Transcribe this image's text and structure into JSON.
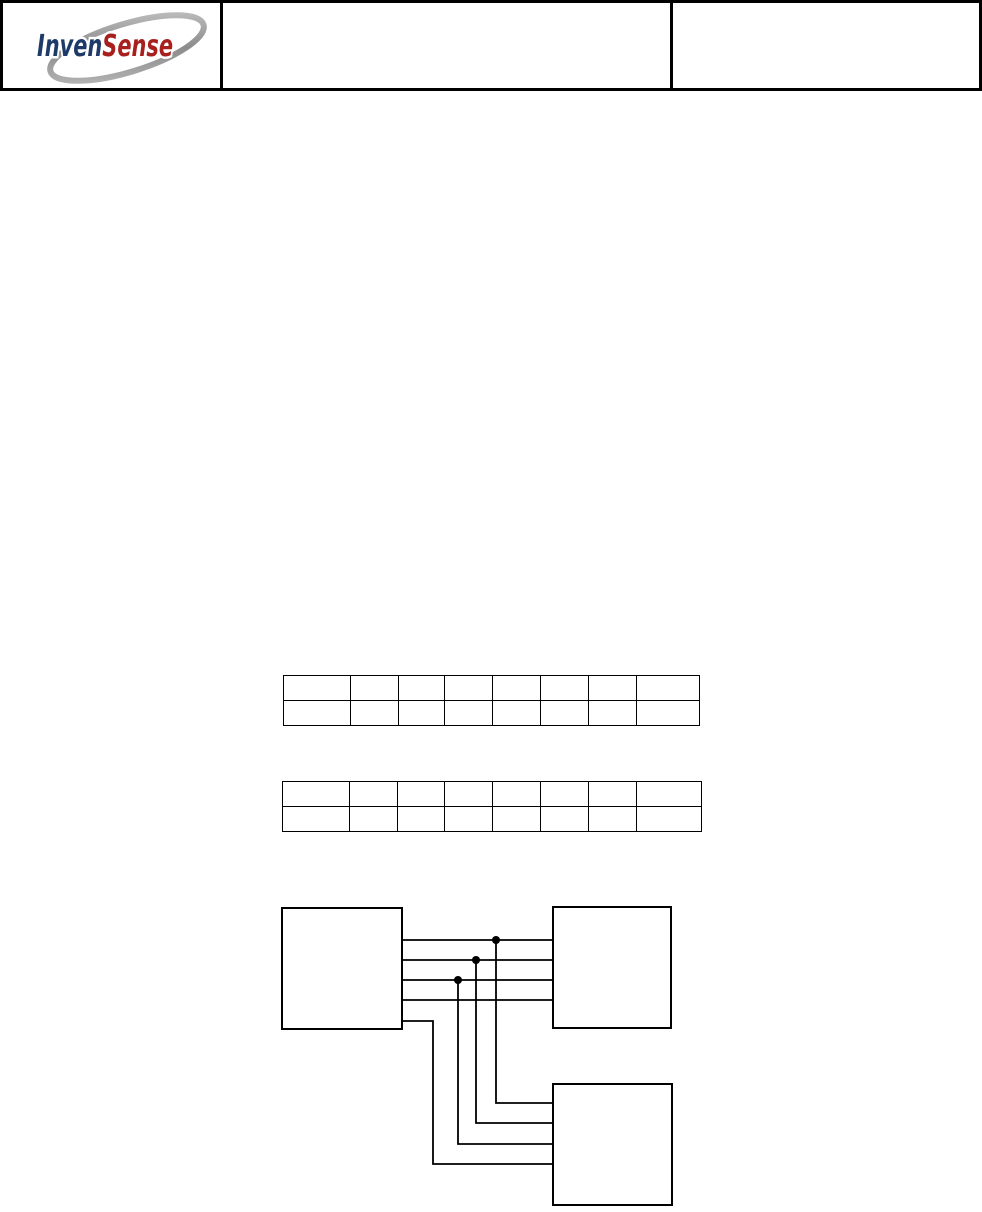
{
  "header": {
    "logo": {
      "part1": "Inven",
      "part2": "Sense",
      "part1_color": "#1e3a68",
      "part2_color": "#a8201e",
      "swoosh_color_light": "#c9c9c9",
      "swoosh_color_dark": "#8c8c8c"
    },
    "title_cell_text": "",
    "info_cell_text": ""
  },
  "tables": [
    {
      "rows": [
        [
          "",
          "",
          "",
          "",
          "",
          "",
          "",
          ""
        ],
        [
          "",
          "",
          "",
          "",
          "",
          "",
          "",
          ""
        ]
      ]
    },
    {
      "rows": [
        [
          "",
          "",
          "",
          "",
          "",
          "",
          "",
          ""
        ],
        [
          "",
          "",
          "",
          "",
          "",
          "",
          "",
          ""
        ]
      ]
    }
  ],
  "diagram": {
    "boxes": [
      {
        "id": "left-box",
        "label": ""
      },
      {
        "id": "top-right-box",
        "label": ""
      },
      {
        "id": "bottom-right-box",
        "label": ""
      }
    ],
    "junction_count": 3,
    "wire_color": "#000000",
    "box_border_color": "#000000",
    "box_fill_color": "#ffffff"
  }
}
